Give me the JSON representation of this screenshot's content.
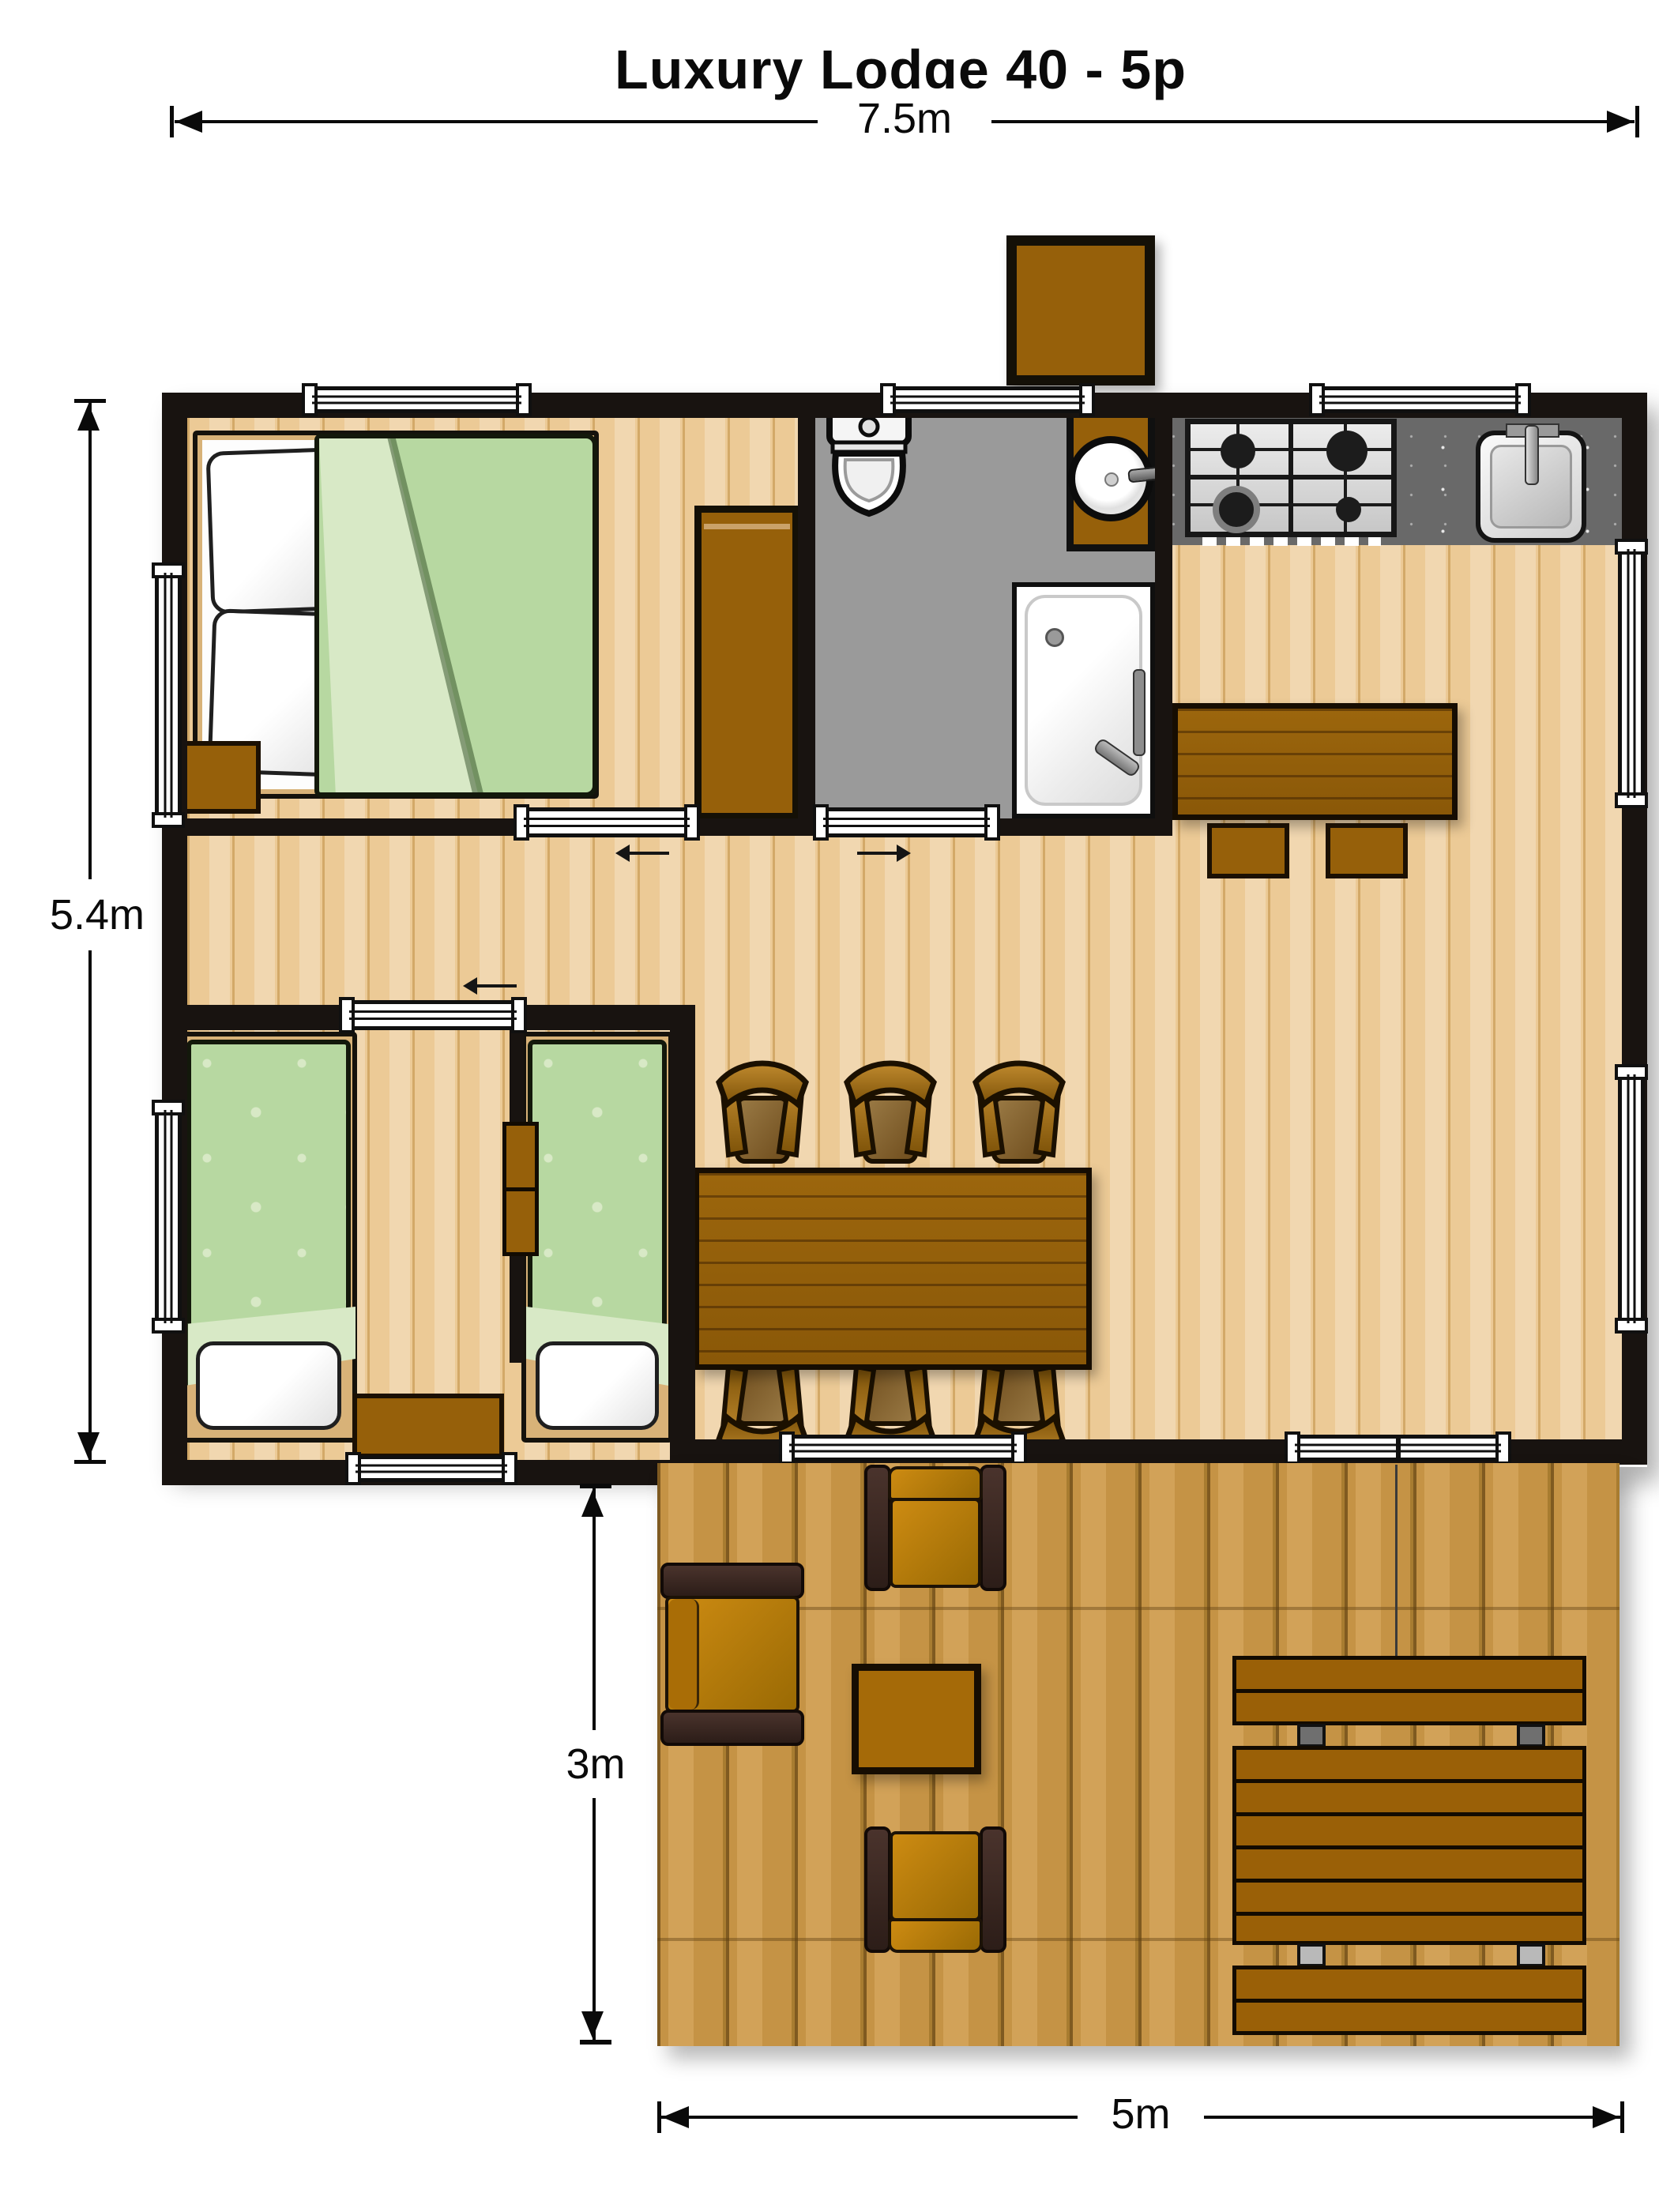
{
  "title": "Luxury Lodge 40 - 5p",
  "dimensions": {
    "overall_width": "7.5m",
    "overall_depth": "5.4m",
    "terrace_depth": "3m",
    "terrace_width": "5m"
  },
  "colors": {
    "wall": "#181310",
    "wood": "#ecca96",
    "wood_line": "#d3a968",
    "bath_floor": "#9a9a9a",
    "counter": "#696969",
    "deck": "#c79549",
    "deck_line": "#7f5a20",
    "brown": "#96600a",
    "brown_dark": "#1b1003",
    "tan": "#d8b278",
    "green": "#b7d8a1",
    "green_light": "#d8e9c6",
    "sofa_dark": "#3c2a24",
    "cushion": "#c07c06"
  }
}
